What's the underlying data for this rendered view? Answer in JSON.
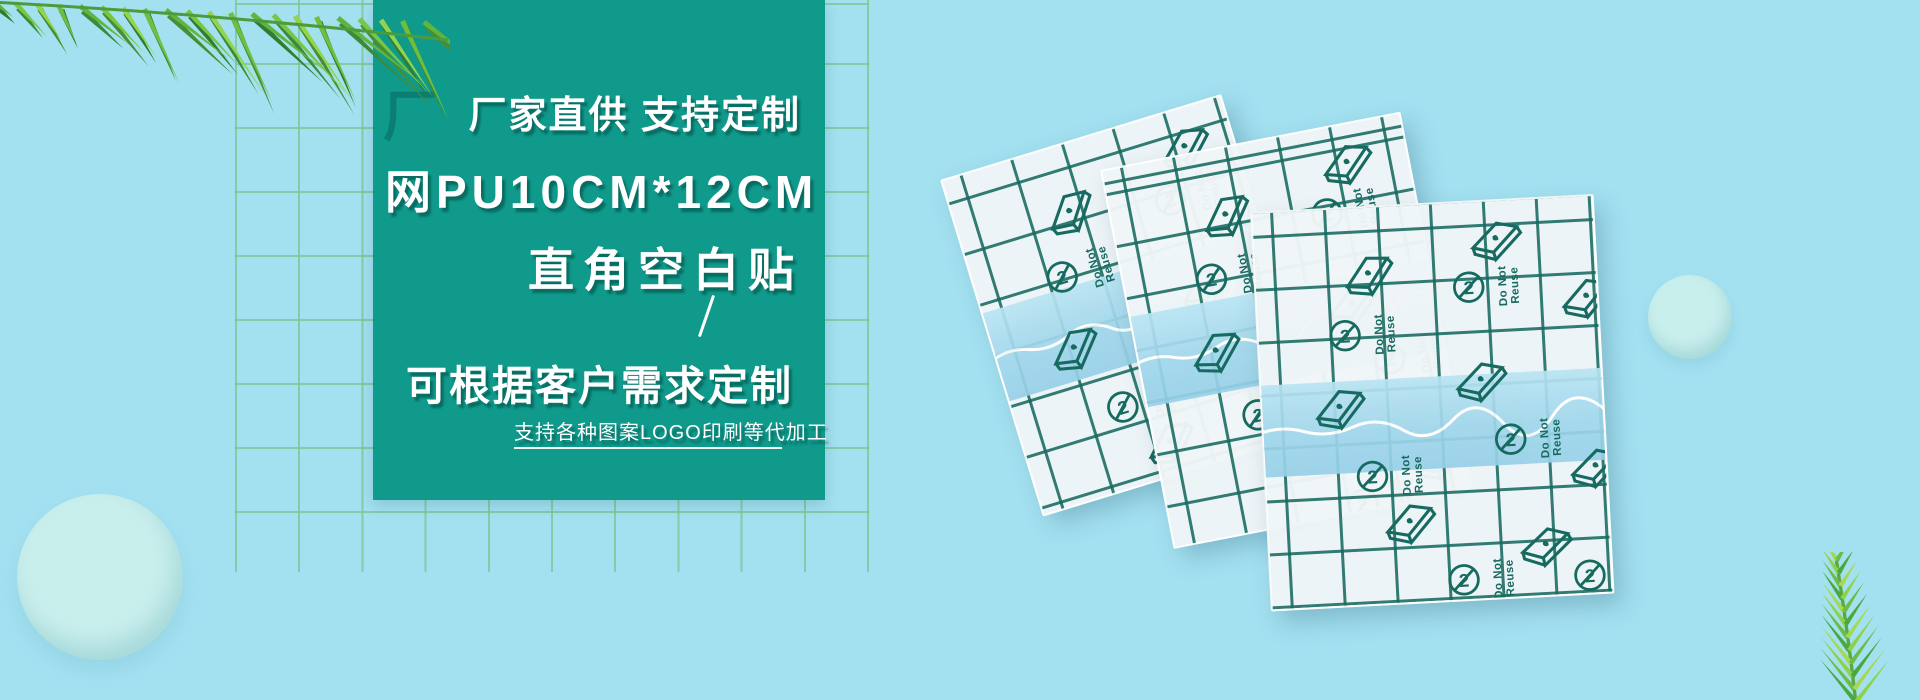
{
  "background": {
    "color": "#a3e1f1",
    "grid_color": "#7cc48e",
    "bubble_color": "#c9efed"
  },
  "panel": {
    "color": "#0f9a8c",
    "watermark": "厂",
    "line1": "厂家直供 支持定制",
    "line2": "网PU10CM*12CM",
    "line3": "直角空白贴",
    "divider": "/",
    "line4": "可根据客户需求定制",
    "line5": "支持各种图案LOGO印刷等代加工"
  },
  "product": {
    "patch_count": 3,
    "patch_label_line1": "Do Not",
    "patch_label_line2": "Reuse",
    "patch_grid_color": "#176a60",
    "patch_band_color": "#a0d6eb"
  },
  "decor": {
    "leaf_color_dark": "#3a8c3b",
    "leaf_color_bright": "#8fd14a"
  }
}
